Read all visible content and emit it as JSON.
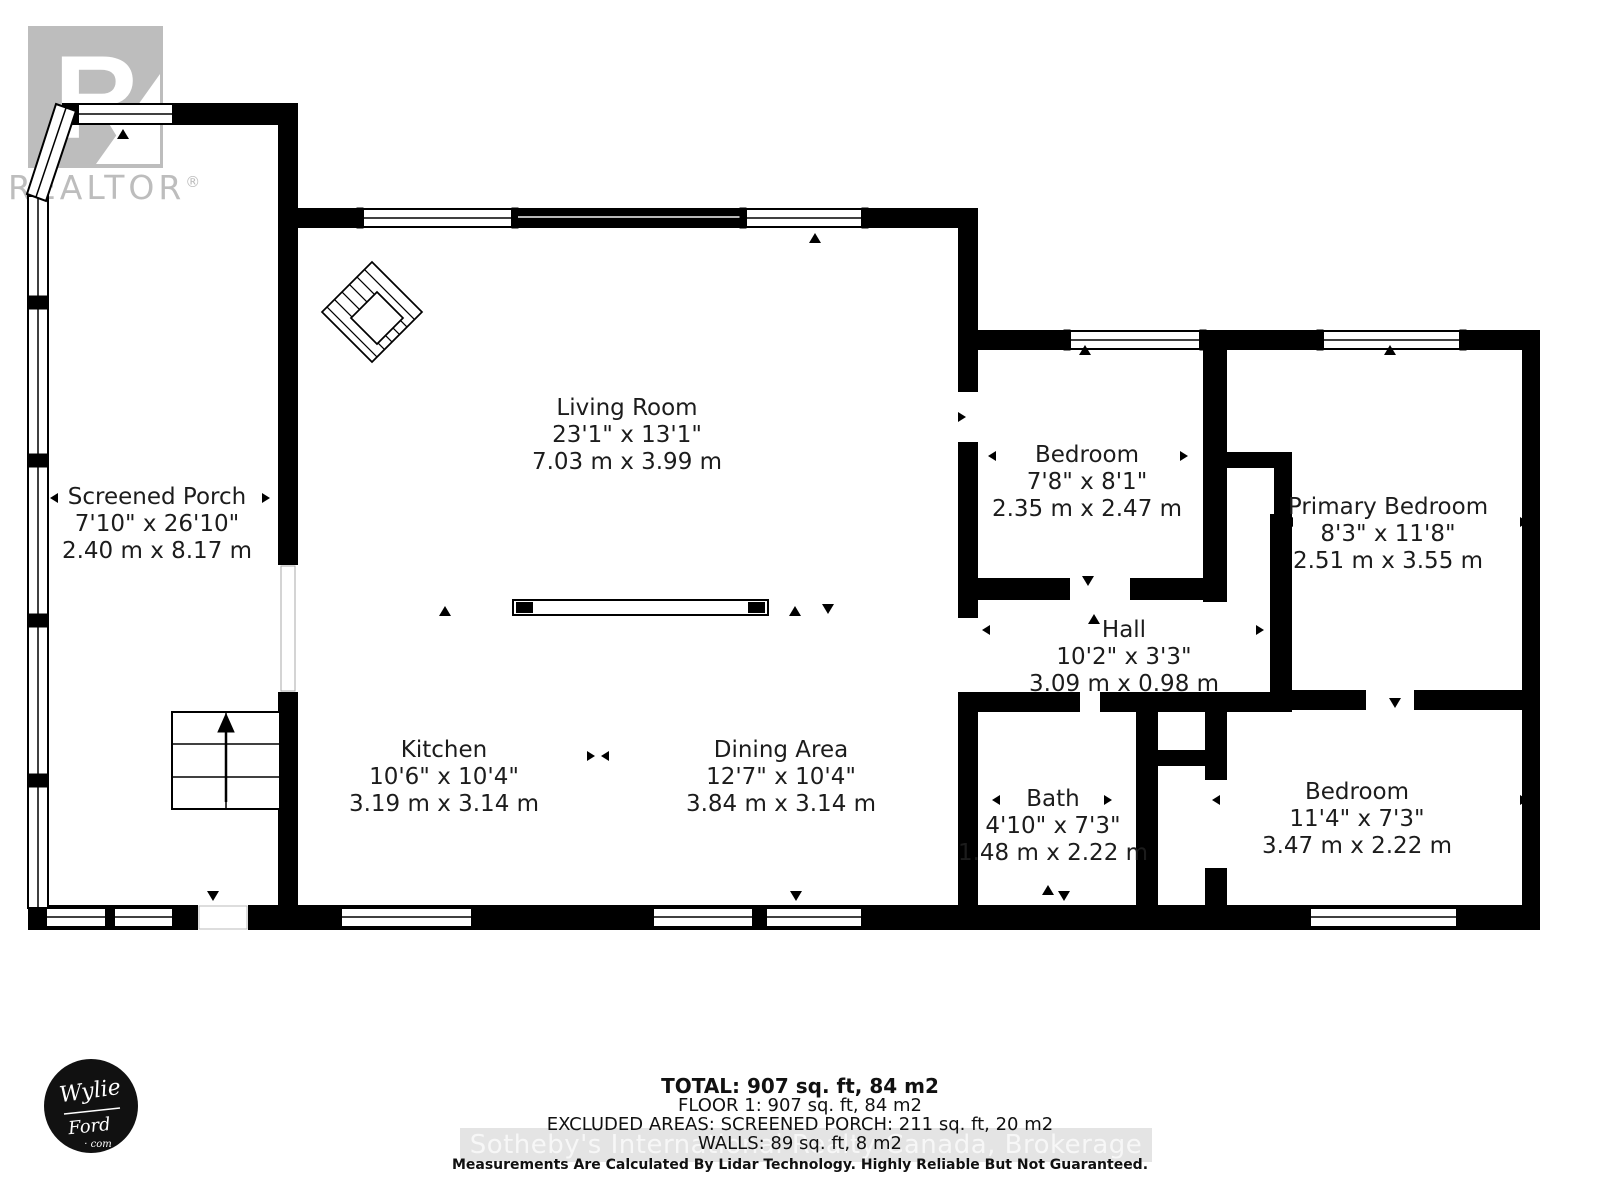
{
  "branding": {
    "realtor_logo_letter": "R",
    "realtor_wordmark": "REALTOR",
    "realtor_reg_mark": "®",
    "wylie_logo_line1": "Wylie",
    "wylie_logo_line2": "Ford",
    "wylie_logo_line3": "· com"
  },
  "watermark": {
    "text": "Sotheby's International Realty Canada, Brokerage"
  },
  "rooms": [
    {
      "name": "Screened Porch",
      "dims_ft": "7'10\" x 26'10\"",
      "dims_m": "2.40 m x 8.17 m"
    },
    {
      "name": "Living Room",
      "dims_ft": "23'1\" x 13'1\"",
      "dims_m": "7.03 m x 3.99 m"
    },
    {
      "name": "Kitchen",
      "dims_ft": "10'6\" x 10'4\"",
      "dims_m": "3.19 m x 3.14 m"
    },
    {
      "name": "Dining Area",
      "dims_ft": "12'7\" x 10'4\"",
      "dims_m": "3.84 m x 3.14 m"
    },
    {
      "name": "Bedroom",
      "dims_ft": "7'8\" x 8'1\"",
      "dims_m": "2.35 m x 2.47 m"
    },
    {
      "name": "Primary Bedroom",
      "dims_ft": "8'3\" x 11'8\"",
      "dims_m": "2.51 m x 3.55 m"
    },
    {
      "name": "Hall",
      "dims_ft": "10'2\" x 3'3\"",
      "dims_m": "3.09 m x 0.98 m"
    },
    {
      "name": "Bath",
      "dims_ft": "4'10\" x 7'3\"",
      "dims_m": "1.48 m x 2.22 m"
    },
    {
      "name": "Bedroom",
      "dims_ft": "11'4\" x 7'3\"",
      "dims_m": "3.47 m x 2.22 m"
    }
  ],
  "footer": {
    "total": "TOTAL: 907 sq. ft, 84 m2",
    "floor": "FLOOR 1: 907 sq. ft, 84 m2",
    "excluded": "EXCLUDED AREAS: SCREENED PORCH: 211 sq. ft, 20 m2",
    "walls": "WALLS: 89 sq. ft, 8 m2",
    "disclaimer": "Measurements Are Calculated By Lidar Technology. Highly Reliable But Not Guaranteed."
  },
  "colors": {
    "wall": "#000000",
    "label_text": "#1c1c1c",
    "logo_gray": "#bdbdbd",
    "watermark_band": "#e4e4e4",
    "watermark_text": "#f7f7f7"
  }
}
